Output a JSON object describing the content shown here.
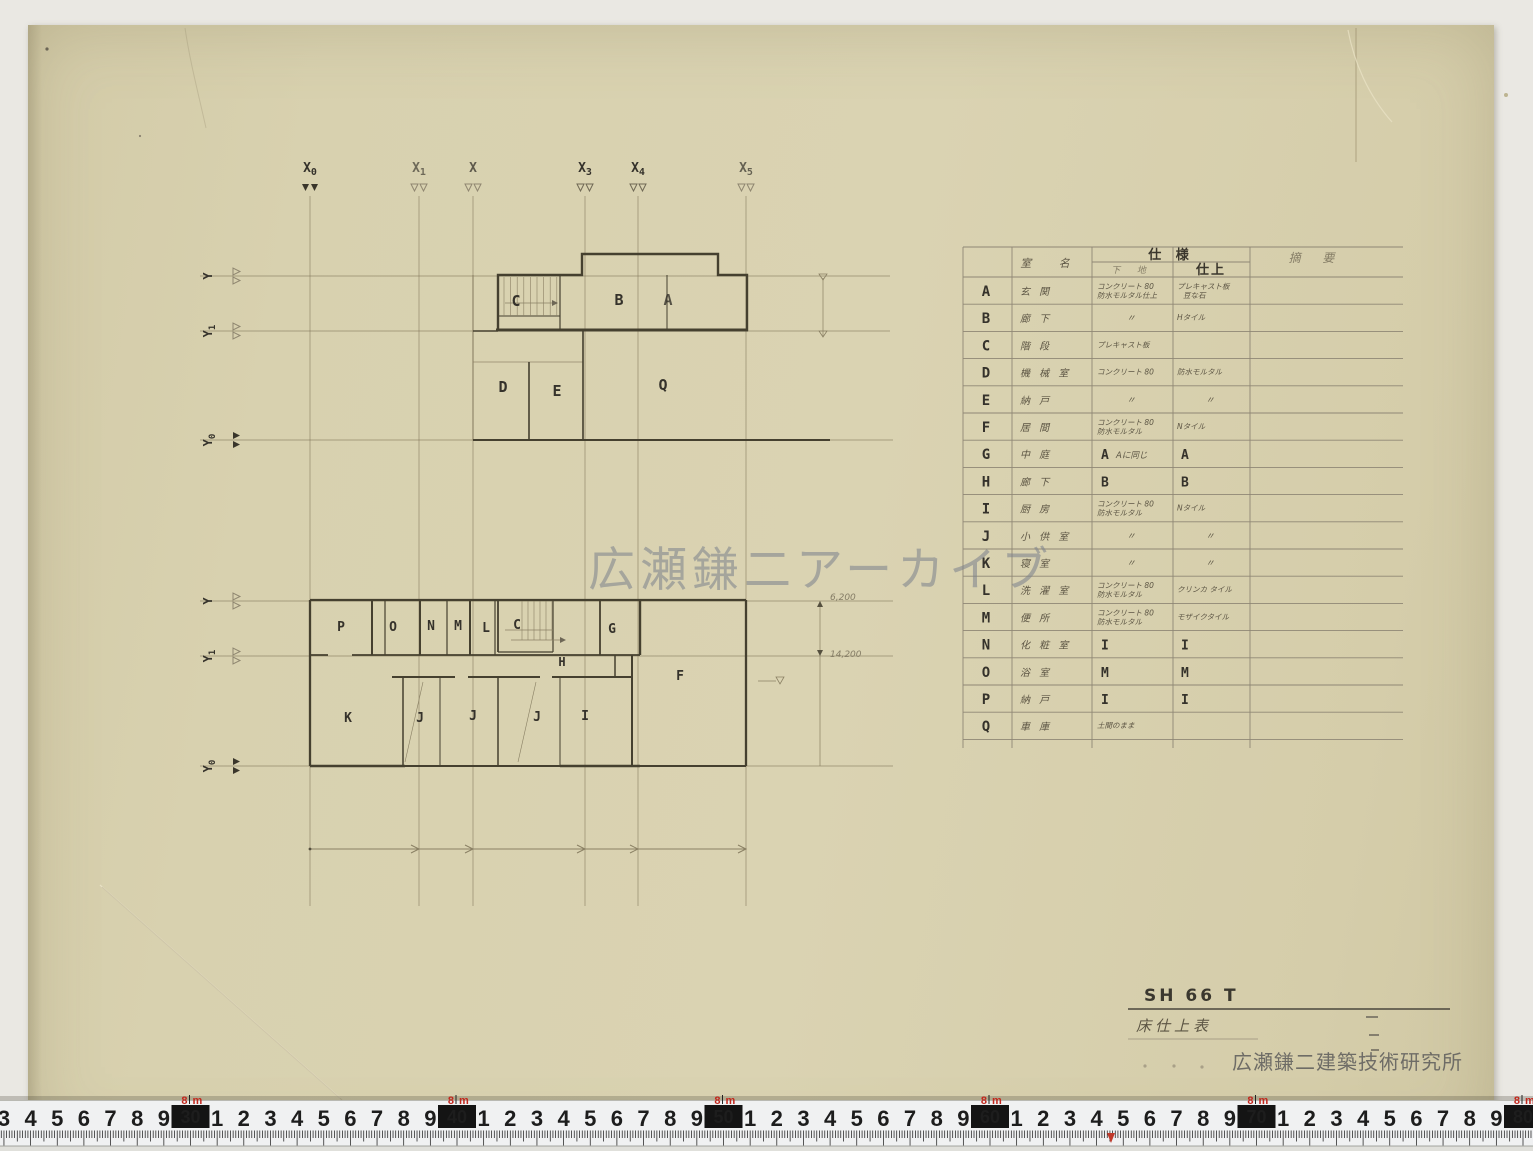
{
  "watermark": "広瀬鎌二アーカイブ",
  "axes": {
    "x": [
      {
        "main": "X",
        "sub": "0"
      },
      {
        "main": "X",
        "sub": "1"
      },
      {
        "main": "X",
        "sub": ""
      },
      {
        "main": "X",
        "sub": "3"
      },
      {
        "main": "X",
        "sub": "4"
      },
      {
        "main": "X",
        "sub": "5"
      }
    ],
    "y_upper": [
      {
        "main": "Y",
        "sub": ""
      },
      {
        "main": "Y",
        "sub": "1"
      },
      {
        "main": "Y",
        "sub": "0"
      }
    ],
    "y_lower": [
      {
        "main": "Y",
        "sub": ""
      },
      {
        "main": "Y",
        "sub": "1"
      },
      {
        "main": "Y",
        "sub": "0"
      }
    ]
  },
  "upper_plan": {
    "rooms": [
      "C",
      "B",
      "A",
      "D",
      "E",
      "Q"
    ]
  },
  "lower_plan": {
    "rooms_top": [
      "P",
      "O",
      "N",
      "M",
      "L",
      "C",
      "G"
    ],
    "rooms_mid": [
      "H",
      "F"
    ],
    "rooms_bottom": [
      "K",
      "J",
      "J",
      "J",
      "I"
    ]
  },
  "dimensions": {
    "dim1": "6,200",
    "dim2": "14,200"
  },
  "schedule": {
    "header": {
      "room_name": "室 名",
      "spec": "仕 様",
      "base": "下 地",
      "finish": "仕上",
      "remarks": "摘 要"
    },
    "rows": [
      {
        "letter": "A",
        "room": "玄 関",
        "base": "コンクリート 80",
        "base2": "防水モルタル仕上",
        "finish": "プレキャスト板",
        "finish2": "豆な石"
      },
      {
        "letter": "B",
        "room": "廊 下",
        "base": "〃",
        "finish": "Hタイル"
      },
      {
        "letter": "C",
        "room": "階 段",
        "base": "プレキャスト板",
        "finish": ""
      },
      {
        "letter": "D",
        "room": "機 械 室",
        "base": "コンクリート 80",
        "finish": "防水モルタル"
      },
      {
        "letter": "E",
        "room": "納 戸",
        "base": "〃",
        "finish": "〃"
      },
      {
        "letter": "F",
        "room": "居 間",
        "base": "コンクリート 80",
        "base2": "防水モルタル",
        "finish": "Nタイル"
      },
      {
        "letter": "G",
        "room": "中 庭",
        "base": "A",
        "base_note": "Aに同じ",
        "finish": "A",
        "bold": true
      },
      {
        "letter": "H",
        "room": "廊 下",
        "base": "B",
        "finish": "B",
        "bold": true
      },
      {
        "letter": "I",
        "room": "厨 房",
        "base": "コンクリート 80",
        "base2": "防水モルタル",
        "finish": "Nタイル"
      },
      {
        "letter": "J",
        "room": "小 供 室",
        "base": "〃",
        "finish": "〃"
      },
      {
        "letter": "K",
        "room": "寝 室",
        "base": "〃",
        "finish": "〃"
      },
      {
        "letter": "L",
        "room": "洗 濯 室",
        "base": "コンクリート 80",
        "base2": "防水モルタル",
        "finish": "クリンカ タイル"
      },
      {
        "letter": "M",
        "room": "便 所",
        "base": "コンクリート 80",
        "base2": "防水モルタル",
        "finish": "モザイクタイル"
      },
      {
        "letter": "N",
        "room": "化 粧 室",
        "base": "I",
        "finish": "I",
        "bold": true
      },
      {
        "letter": "O",
        "room": "浴 室",
        "base": "M",
        "finish": "M",
        "bold": true
      },
      {
        "letter": "P",
        "room": "納 戸",
        "base": "I",
        "finish": "I",
        "bold": true
      },
      {
        "letter": "Q",
        "room": "車 庫",
        "base": "土間のまま",
        "finish": ""
      }
    ]
  },
  "title_block": {
    "code": "SH 66 T",
    "title": "床仕上表",
    "firm": "広瀬鎌二建築技術研究所"
  },
  "ruler": {
    "meter_digit": "8",
    "meter_unit": "m",
    "start_cm": 23,
    "end_cm": 80,
    "decade_boxes": [
      "30",
      "40",
      "50",
      "60",
      "70",
      "80"
    ]
  },
  "colors": {
    "sheet": "#d7cfad",
    "background": "#eae8e3",
    "pencil": "#45402f",
    "table_line": "#8f8775",
    "ruler_red": "#c2271d",
    "watermark": "#7b818c"
  }
}
